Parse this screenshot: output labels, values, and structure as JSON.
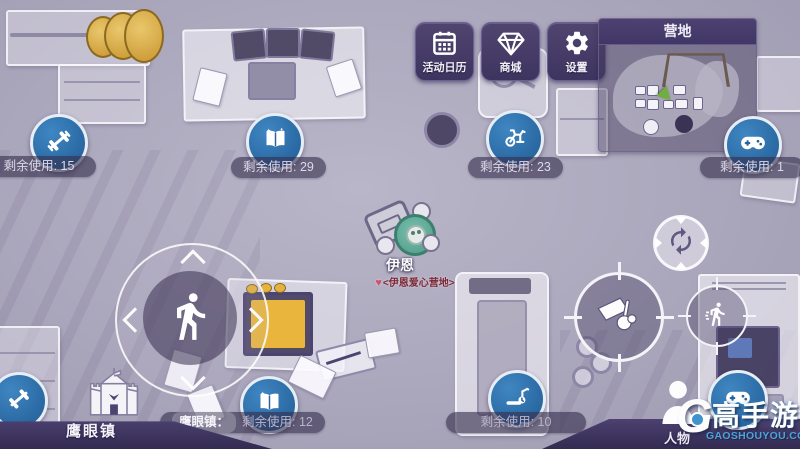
{
  "colors": {
    "facility_blue": "#2e6da9",
    "panel_purple": "#453a60",
    "barbell_gold": "#d9a83e",
    "camp_tag_red": "#7e2837",
    "watermark_blue": "#4aa3da",
    "monitor_orange": "#e9b53c",
    "minimap_arrow_green": "#6fae3f"
  },
  "top_buttons": [
    {
      "label": "活动日历",
      "icon": "calendar-icon"
    },
    {
      "label": "商城",
      "icon": "gem-icon"
    },
    {
      "label": "设置",
      "icon": "gear-icon"
    }
  ],
  "minimap": {
    "title": "营地"
  },
  "counters": {
    "gym": {
      "icon": "dumbbell-icon",
      "text": "剩余使用: 15"
    },
    "study": {
      "icon": "book-icon",
      "text": "剩余使用: 29"
    },
    "bike": {
      "icon": "exercise-bike-icon",
      "text": "剩余使用: 23"
    },
    "arcade": {
      "icon": "gamepad-icon",
      "text": "剩余使用: 1"
    },
    "town_study": {
      "icon": "book-icon",
      "prefix": "鹰眼镇：",
      "text": "剩余使用: 12"
    },
    "treadmill": {
      "icon": "treadmill-icon",
      "text": "剩余使用: 10"
    }
  },
  "player": {
    "name": "伊恩",
    "camp_tag": "<伊恩爱心营地>"
  },
  "town": {
    "label": "鹰眼镇"
  },
  "bottom_menu": {
    "character_label": "人物",
    "storage_label": "仓库"
  },
  "watermark": {
    "letter": "G",
    "brand": "高手游",
    "url": "GAOSHOUYOU.COM"
  }
}
